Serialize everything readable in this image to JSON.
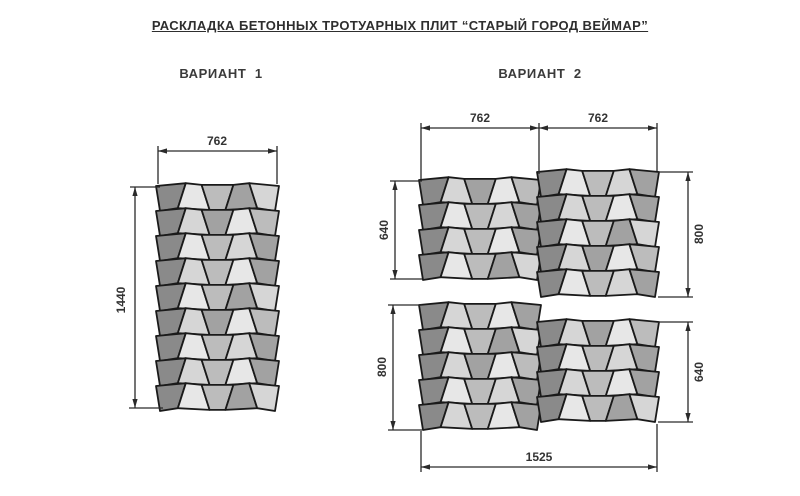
{
  "title": "РАСКЛАДКА БЕТОННЫХ ТРОТУАРНЫХ ПЛИТ “СТАРЫЙ ГОРОД ВЕЙМАР”",
  "variants": [
    {
      "label": "ВАРИАНТ  1"
    },
    {
      "label": "ВАРИАНТ  2"
    }
  ],
  "colors": {
    "background": "#ffffff",
    "tile_stroke": "#1a1a1a",
    "dim_line": "#2a2a2a",
    "dim_text": "#333333",
    "palette": [
      "#8a8a8a",
      "#a2a2a2",
      "#bcbcbc",
      "#d6d6d6",
      "#e7e7e7"
    ]
  },
  "geometry": {
    "tilt_inner": 4,
    "tilt_edge": 2,
    "wave": [
      0,
      -2.8,
      -1.1,
      -1.1,
      -2.8,
      0
    ],
    "tile_stroke_width": 1.8,
    "dim_stroke_width": 1.3
  },
  "pattern": [
    [
      0,
      4,
      2,
      1,
      3
    ],
    [
      0,
      3,
      1,
      4,
      2
    ],
    [
      0,
      4,
      2,
      3,
      1
    ],
    [
      0,
      3,
      2,
      4,
      1
    ]
  ],
  "blocks": [
    {
      "name": "variant1-block",
      "x": 158,
      "y": 186,
      "cols": 5,
      "rows": 9,
      "tileW": 23.8,
      "tileH": 25,
      "seed": 0
    },
    {
      "name": "variant2-upper-left",
      "x": 421,
      "y": 180,
      "cols": 5,
      "rows": 4,
      "tileW": 23.6,
      "tileH": 25,
      "seed": 1
    },
    {
      "name": "variant2-upper-right",
      "x": 539,
      "y": 172,
      "cols": 5,
      "rows": 5,
      "tileW": 23.6,
      "tileH": 25,
      "seed": 2
    },
    {
      "name": "variant2-lower-left",
      "x": 421,
      "y": 305,
      "cols": 5,
      "rows": 5,
      "tileW": 23.6,
      "tileH": 25,
      "seed": 3
    },
    {
      "name": "variant2-lower-right",
      "x": 539,
      "y": 322,
      "cols": 5,
      "rows": 4,
      "tileW": 23.6,
      "tileH": 25,
      "seed": 1
    }
  ],
  "dimensions": [
    {
      "name": "v1-width",
      "label": "762",
      "orient": "h",
      "y": 151,
      "x1": 158,
      "x2": 277,
      "lx": 217,
      "ly": 142,
      "rot": 0,
      "ext": [
        [
          158,
          146,
          158,
          184
        ],
        [
          277,
          146,
          277,
          184
        ]
      ]
    },
    {
      "name": "v1-height",
      "label": "1440",
      "orient": "v",
      "x": 135,
      "y1": 187,
      "y2": 408,
      "lx": 122,
      "ly": 300,
      "rot": -90,
      "ext": [
        [
          130,
          187,
          160,
          187
        ],
        [
          129,
          408,
          163,
          408
        ]
      ]
    },
    {
      "name": "v2-top-width-left",
      "label": "762",
      "orient": "h",
      "y": 128,
      "x1": 421,
      "x2": 539,
      "lx": 480,
      "ly": 119,
      "rot": 0,
      "ext": [
        [
          421,
          123,
          421,
          179
        ],
        [
          539,
          123,
          539,
          174
        ]
      ]
    },
    {
      "name": "v2-top-width-right",
      "label": "762",
      "orient": "h",
      "y": 128,
      "x1": 539,
      "x2": 657,
      "lx": 598,
      "ly": 119,
      "rot": 0,
      "ext": [
        [
          657,
          123,
          657,
          171
        ]
      ]
    },
    {
      "name": "v2-upper-left-height",
      "label": "640",
      "orient": "v",
      "x": 395,
      "y1": 181,
      "y2": 279,
      "lx": 385,
      "ly": 230,
      "rot": -90,
      "ext": [
        [
          390,
          181,
          422,
          181
        ],
        [
          390,
          279,
          422,
          279
        ]
      ]
    },
    {
      "name": "v2-upper-right-height",
      "label": "800",
      "orient": "v",
      "x": 688,
      "y1": 172,
      "y2": 297,
      "lx": 700,
      "ly": 234,
      "rot": -90,
      "ext": [
        [
          658,
          172,
          693,
          172
        ],
        [
          658,
          297,
          693,
          297
        ]
      ]
    },
    {
      "name": "v2-lower-left-height",
      "label": "800",
      "orient": "v",
      "x": 393,
      "y1": 305,
      "y2": 430,
      "lx": 383,
      "ly": 367,
      "rot": -90,
      "ext": [
        [
          388,
          305,
          422,
          305
        ],
        [
          388,
          430,
          422,
          430
        ]
      ]
    },
    {
      "name": "v2-lower-right-height",
      "label": "640",
      "orient": "v",
      "x": 688,
      "y1": 322,
      "y2": 422,
      "lx": 700,
      "ly": 372,
      "rot": -90,
      "ext": [
        [
          658,
          322,
          693,
          322
        ],
        [
          658,
          422,
          693,
          422
        ]
      ]
    },
    {
      "name": "v2-total-width",
      "label": "1525",
      "orient": "h",
      "y": 467,
      "x1": 421,
      "x2": 657,
      "lx": 539,
      "ly": 458,
      "rot": 0,
      "ext": [
        [
          421,
          431,
          421,
          472
        ],
        [
          657,
          424,
          657,
          472
        ]
      ]
    }
  ]
}
